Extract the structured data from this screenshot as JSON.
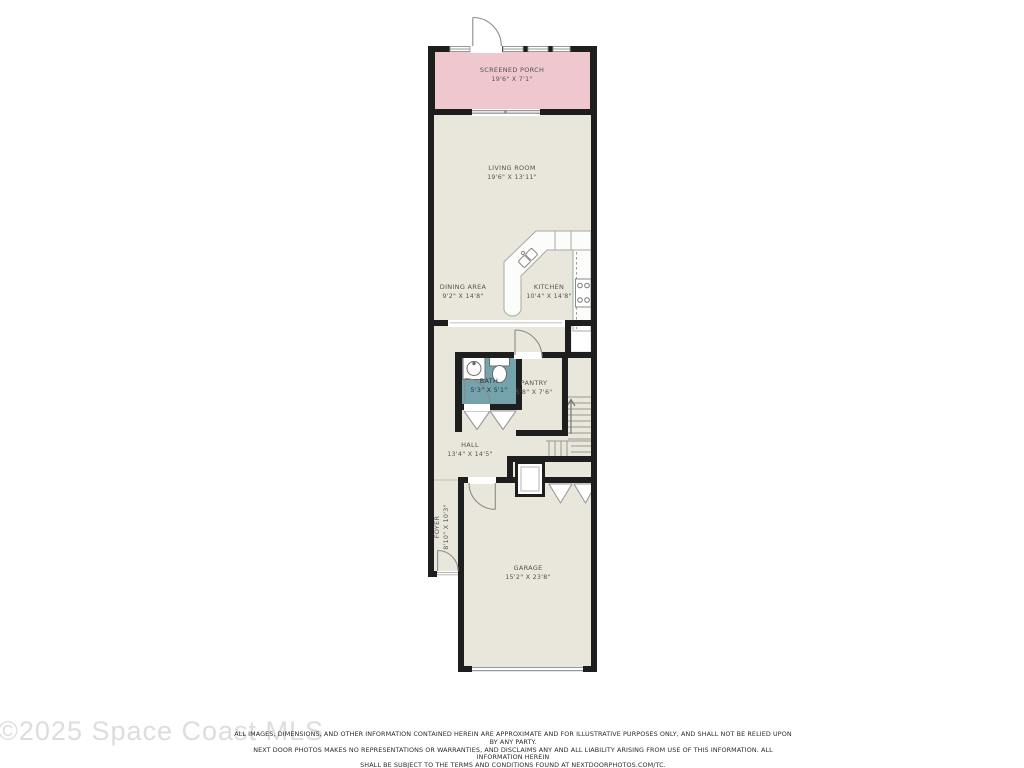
{
  "floorplan": {
    "rooms": [
      {
        "name": "SCREENED PORCH",
        "dims": "19'6\" X 7'1\""
      },
      {
        "name": "LIVING ROOM",
        "dims": "19'6\" X 13'11\""
      },
      {
        "name": "DINING AREA",
        "dims": "9'2\" X 14'8\""
      },
      {
        "name": "KITCHEN",
        "dims": "10'4\" X 14'8\""
      },
      {
        "name": "BATH",
        "dims": "5'3\" X 5'1\""
      },
      {
        "name": "PANTRY",
        "dims": "5'8\" X 7'6\""
      },
      {
        "name": "HALL",
        "dims": "13'4\" X 14'5\""
      },
      {
        "name": "FOYER",
        "dims": "8'10\" X 10'3\""
      },
      {
        "name": "GARAGE",
        "dims": "15'2\" X 23'8\""
      }
    ],
    "colors": {
      "porch_fill": "#efc8cf",
      "room_fill": "#e9e7dc",
      "bath_fill": "#74a2ad",
      "wall": "#1e1e1e",
      "label_text": "#55544e"
    },
    "fixtures": [
      "kitchen-sink",
      "range",
      "kitchen-counter",
      "upper-cabinet-dashed",
      "bath-vanity-sink",
      "toilet",
      "staircase-up-arrow",
      "water-heater",
      "bifold-closet-chevrons",
      "door-swing-arcs",
      "windows",
      "garage-door",
      "sliding-glass-door"
    ]
  },
  "footer": {
    "watermark": "©2025 Space Coast MLS",
    "disclaimer": [
      "ALL IMAGES, DIMENSIONS, AND OTHER INFORMATION CONTAINED HEREIN ARE APPROXIMATE AND FOR ILLUSTRATIVE PURPOSES ONLY, AND SHALL NOT BE RELIED UPON BY ANY PARTY.",
      "NEXT DOOR PHOTOS MAKES NO REPRESENTATIONS OR WARRANTIES, AND DISCLAIMS ANY AND ALL LIABILITY ARISING FROM USE OF THIS INFORMATION. ALL INFORMATION HEREIN",
      "SHALL BE SUBJECT TO THE TERMS AND CONDITIONS FOUND AT NEXTDOORPHOTOS.COM/TC."
    ]
  }
}
